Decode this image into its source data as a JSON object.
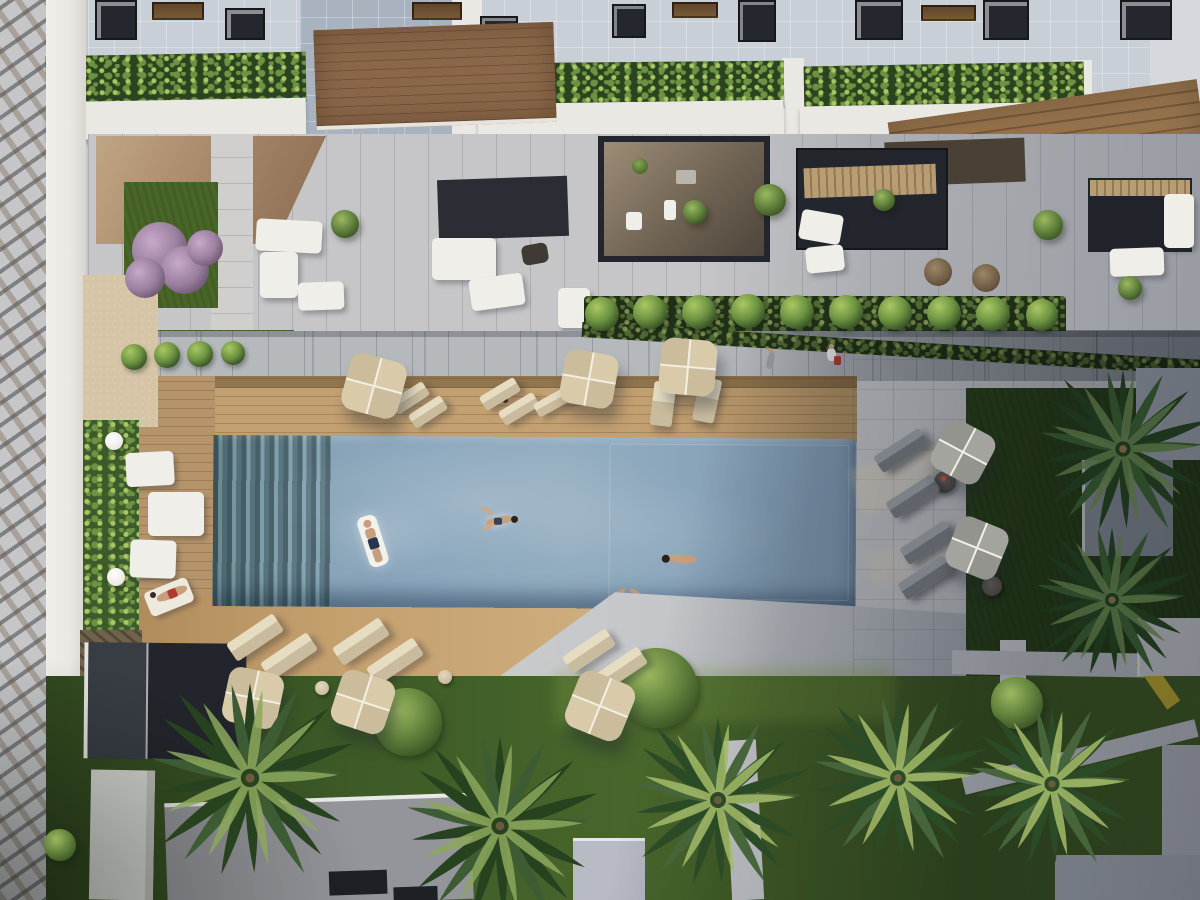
{
  "meta": {
    "type": "3d-architectural-rendering",
    "view": "top-down-aerial",
    "subject": "residential apartment complex courtyard with long rectangular swimming pool, wooden sun deck, lounge chairs, parasols, palm trees, hedged balconies and lawns",
    "lighting": "low sun from upper-left; right third of the courtyard lies in building shadow",
    "visible_text": "none"
  },
  "palette": {
    "rock": "#43464d",
    "rock_dark": "#2e3137",
    "rock_streak": "#6f5b47",
    "wall": "#eae8e2",
    "sand": "#d5c5a6",
    "ivy": "#3d5a2c",
    "roof": "#c9cfd7",
    "roof_blue": "#a9b3c0",
    "roof_brown": "#8a674a",
    "roof_brown_dark": "#6b4e35",
    "awning": "#23262c",
    "awning_brown": "#4a4136",
    "slat_tan": "#b99d72",
    "terrace": "#c6c6c8",
    "walkway": "#b6b9bc",
    "deck": "#c2a071",
    "deck_dark": "#a8875d",
    "pool": "#8ca7bd",
    "pool_light": "#a2b8c8",
    "pool_dark": "#5d7590",
    "pool_reflect": "#27444a",
    "paving": "#c3c4c7",
    "paving_shade": "#878e98",
    "wedge": "#c8c9cc",
    "grass": "#486628",
    "grass_dark": "#2c4520",
    "grass_lit": "#5f7f33",
    "hedge_base": "#2b431f",
    "hedge_leaf": "#6d9342",
    "hedge_leaf2": "#a9c763",
    "umb": "#d9cbaa",
    "umb2": "#cbbd9c",
    "umb_rib": "#f3efe4",
    "umb_shade": "#a3a49e",
    "umb_shade2": "#93948e",
    "lounger": "#c9bc9e",
    "lounger_top": "#e6dcc2",
    "lounger_shade": "#5f646a",
    "lounger_shade_top": "#7d8288",
    "furn_white": "#f0eee8",
    "skin": "#c99e7c",
    "red": "#b03a30",
    "orange": "#c07a3e",
    "white_path": "#d9dadc",
    "yellow": "#cdb63a"
  },
  "scene": {
    "pool": {
      "people_in_pool": 4,
      "float_rafts": 1
    },
    "palms": [
      [
        250,
        778,
        115,
        "mid"
      ],
      [
        500,
        826,
        108,
        "mid"
      ],
      [
        718,
        800,
        100,
        "lit"
      ],
      [
        898,
        778,
        98,
        "lit"
      ],
      [
        1052,
        784,
        95,
        "lit"
      ],
      [
        1123,
        449,
        96,
        "shadow"
      ],
      [
        1112,
        600,
        88,
        "shadow"
      ]
    ],
    "umbrellas": [
      [
        374,
        386,
        58,
        15,
        "lit"
      ],
      [
        589,
        379,
        54,
        10,
        "lit"
      ],
      [
        688,
        367,
        56,
        5,
        "lit"
      ],
      [
        253,
        698,
        56,
        12,
        "lit"
      ],
      [
        363,
        702,
        56,
        18,
        "lit"
      ],
      [
        600,
        706,
        60,
        22,
        "lit"
      ],
      [
        963,
        452,
        54,
        28,
        "shade"
      ],
      [
        977,
        548,
        54,
        22,
        "shade"
      ]
    ],
    "loungers": [
      [
        410,
        398,
        38,
        16,
        -33,
        "lit"
      ],
      [
        428,
        412,
        38,
        16,
        -33,
        "lit"
      ],
      [
        500,
        394,
        40,
        16,
        -31,
        "lit"
      ],
      [
        519,
        409,
        40,
        16,
        -31,
        "lit"
      ],
      [
        552,
        402,
        36,
        15,
        -29,
        "lit"
      ],
      [
        663,
        404,
        22,
        44,
        7,
        "lit"
      ],
      [
        707,
        400,
        22,
        44,
        12,
        "lit"
      ],
      [
        255,
        637,
        56,
        21,
        -34,
        "lit"
      ],
      [
        289,
        656,
        56,
        21,
        -34,
        "lit"
      ],
      [
        361,
        641,
        56,
        21,
        -34,
        "lit"
      ],
      [
        395,
        661,
        56,
        21,
        -34,
        "lit"
      ],
      [
        589,
        651,
        52,
        20,
        -34,
        "lit"
      ],
      [
        621,
        669,
        52,
        20,
        -34,
        "lit"
      ],
      [
        901,
        450,
        54,
        19,
        -33,
        "shade"
      ],
      [
        913,
        496,
        54,
        19,
        -33,
        "shade"
      ],
      [
        927,
        542,
        54,
        19,
        -33,
        "shade"
      ],
      [
        925,
        577,
        54,
        19,
        -33,
        "shade"
      ]
    ],
    "bushes": [
      [
        602,
        314,
        17,
        "hedge"
      ],
      [
        650,
        312,
        17,
        "hedge"
      ],
      [
        699,
        312,
        17,
        "hedge"
      ],
      [
        748,
        311,
        17,
        "hedge"
      ],
      [
        797,
        312,
        17,
        "hedge"
      ],
      [
        846,
        312,
        17,
        "hedge"
      ],
      [
        895,
        313,
        17,
        "hedge"
      ],
      [
        944,
        313,
        17,
        "hedge"
      ],
      [
        993,
        314,
        17,
        "hedge"
      ],
      [
        1042,
        315,
        16,
        "hedge"
      ],
      [
        134,
        357,
        13,
        "hedge"
      ],
      [
        167,
        355,
        13,
        "hedge"
      ],
      [
        200,
        354,
        13,
        "hedge"
      ],
      [
        233,
        353,
        12,
        "hedge"
      ],
      [
        658,
        688,
        40,
        "tree"
      ],
      [
        408,
        722,
        34,
        "tree"
      ],
      [
        1017,
        703,
        26,
        "tree"
      ],
      [
        60,
        845,
        16,
        "tree"
      ],
      [
        770,
        200,
        16,
        "tree"
      ],
      [
        1048,
        225,
        15,
        "tree"
      ],
      [
        345,
        224,
        14,
        "tree"
      ],
      [
        1130,
        288,
        12,
        "tree"
      ],
      [
        695,
        212,
        12,
        "tree"
      ],
      [
        884,
        200,
        11,
        "tree"
      ],
      [
        160,
        250,
        28,
        "purple"
      ],
      [
        185,
        270,
        24,
        "purple"
      ],
      [
        145,
        278,
        20,
        "purple"
      ],
      [
        205,
        248,
        18,
        "purple"
      ]
    ],
    "tables": [
      [
        114,
        441,
        9,
        "white"
      ],
      [
        116,
        577,
        9,
        "white"
      ],
      [
        445,
        677,
        7,
        "beige"
      ],
      [
        322,
        688,
        7,
        "beige"
      ],
      [
        945,
        482,
        11,
        "dark"
      ],
      [
        992,
        586,
        10,
        "dark"
      ],
      [
        938,
        272,
        14,
        "rattan"
      ],
      [
        986,
        278,
        14,
        "rattan"
      ]
    ]
  }
}
